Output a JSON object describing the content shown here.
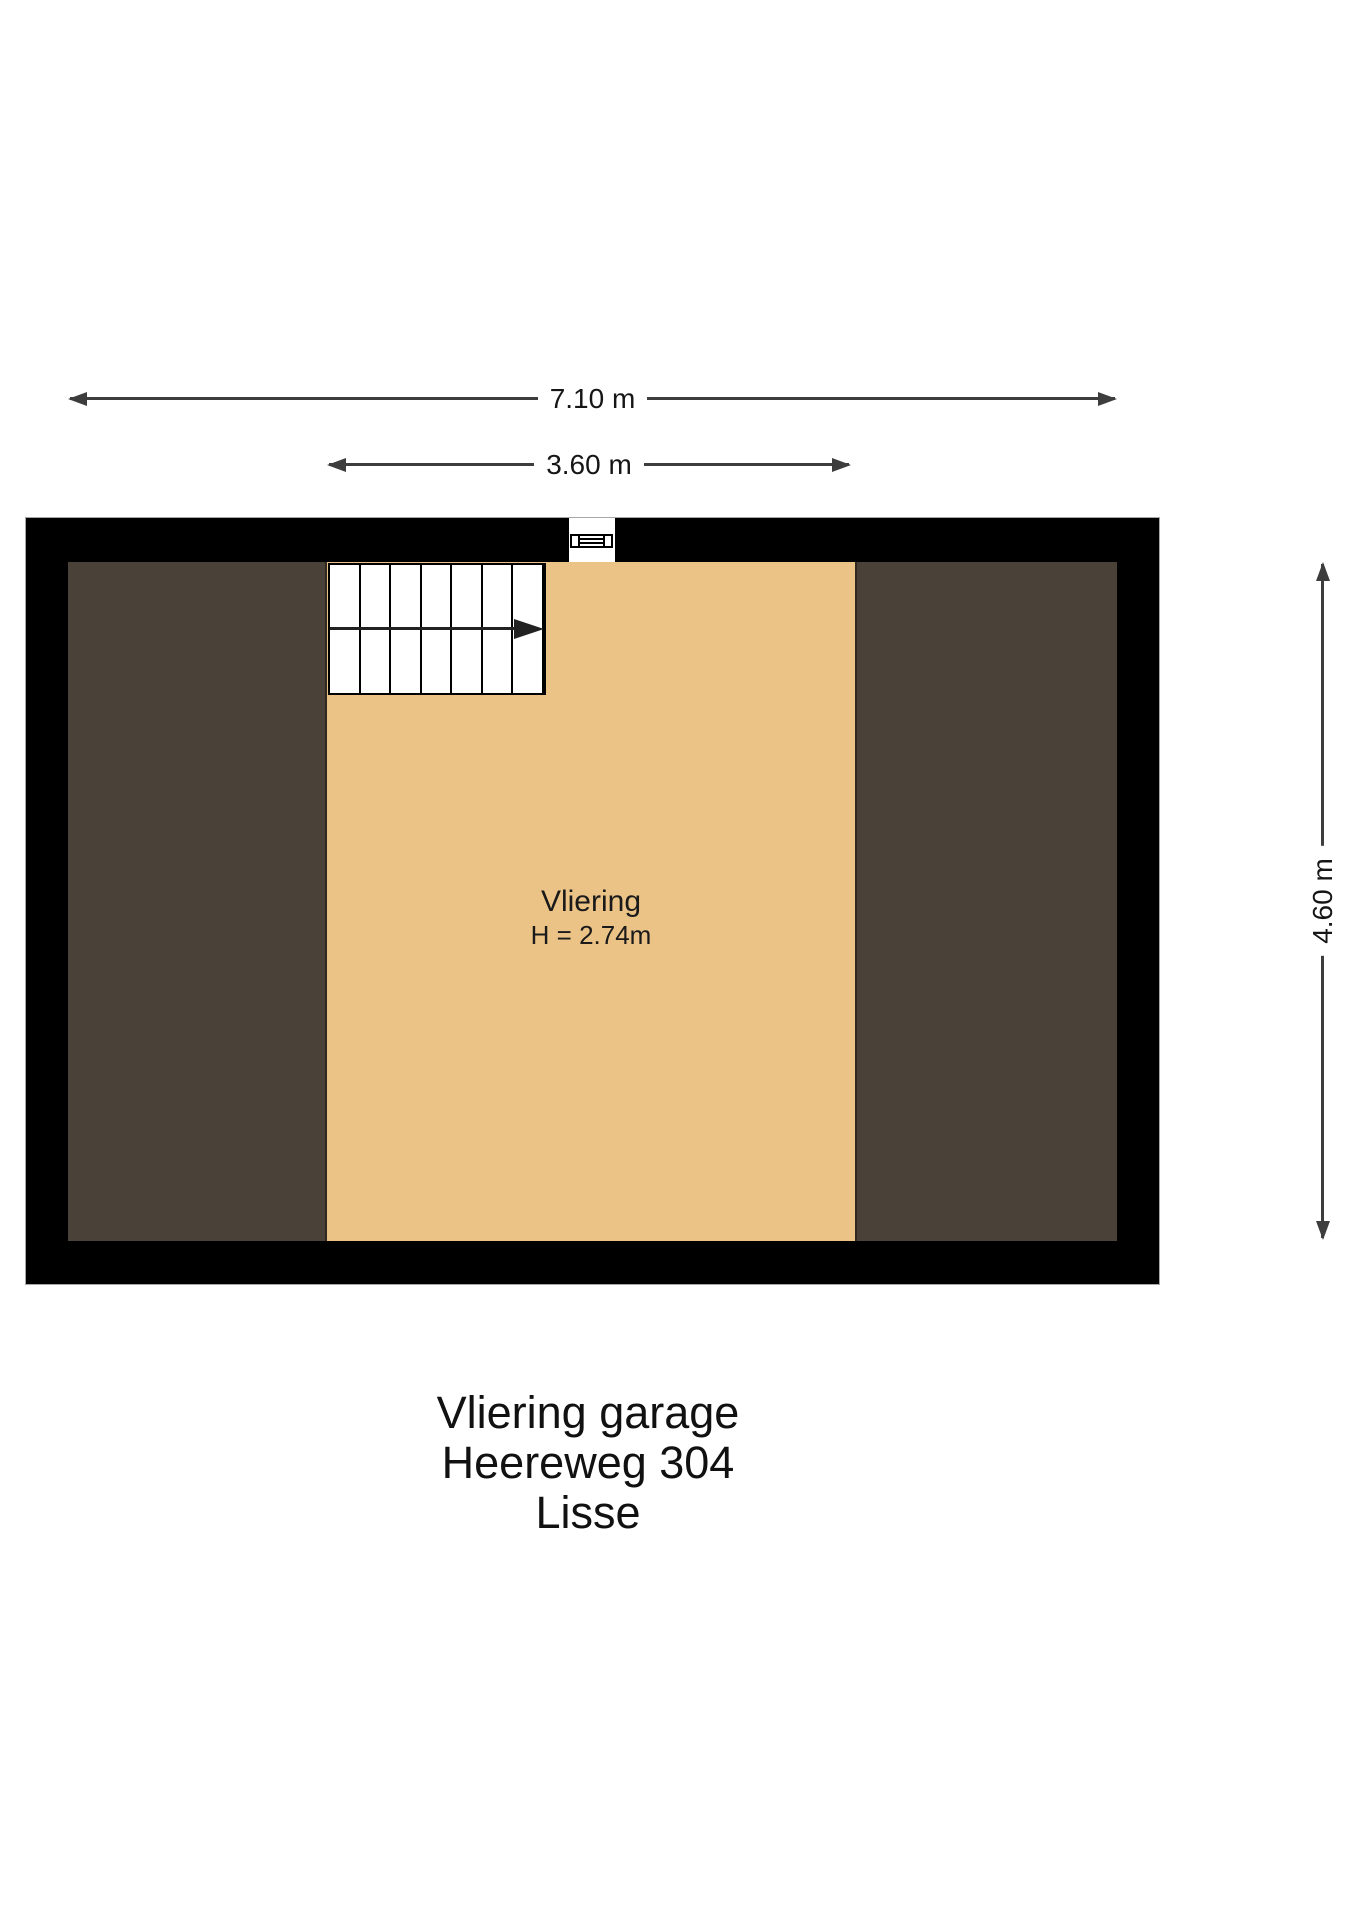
{
  "dimensions": {
    "total_width": {
      "label": "7.10 m"
    },
    "vliering_width": {
      "label": "3.60 m"
    },
    "total_height": {
      "label": "4.60 m"
    }
  },
  "room": {
    "name": "Vliering",
    "height_label": "H = 2.74m"
  },
  "footer": {
    "lines": [
      "Vliering garage",
      "Heereweg 304",
      "Lisse"
    ]
  },
  "colors": {
    "background": "#ffffff",
    "wall": "#000000",
    "floor": "#ebc386",
    "attic": "#4a4238",
    "dim_line": "#3d3d3d"
  }
}
